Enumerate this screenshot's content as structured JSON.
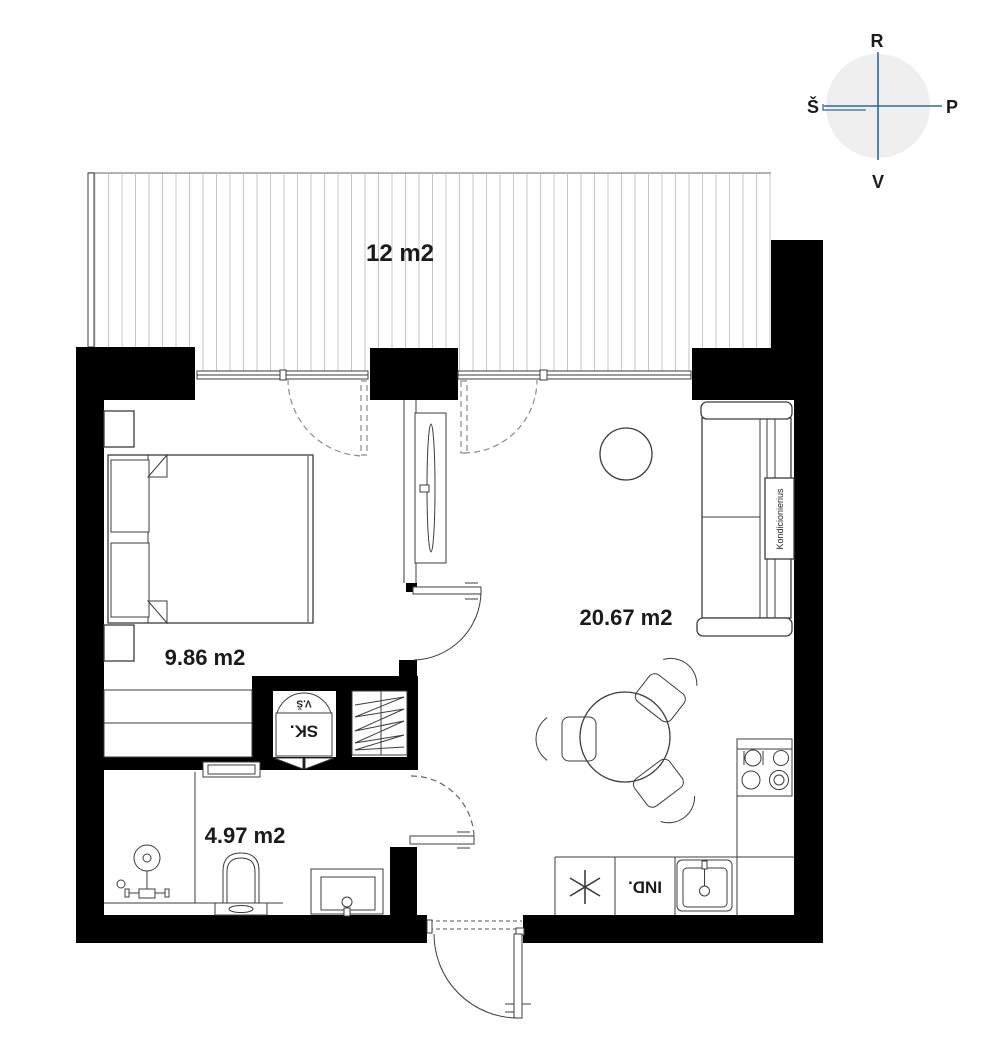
{
  "compass": {
    "top": "R",
    "right": "P",
    "bottom": "V",
    "left": "Š"
  },
  "rooms": {
    "terrace": {
      "area": "12 m2"
    },
    "bedroom": {
      "area": "9.86 m2"
    },
    "living_room": {
      "area": "20.67 m2"
    },
    "bathroom": {
      "area": "4.97 m2"
    }
  },
  "fixtures": {
    "shaft": "SK.",
    "vent": "V.Š",
    "dishwasher": "IND.",
    "air_conditioner": "Kondicionierius"
  },
  "colors": {
    "wall": "#000000",
    "line": "#3c3c3c",
    "deck_line": "#c6c6c6",
    "compass_line": "#2a6a9b",
    "compass_fill": "#efefef",
    "text": "#1b1b1b"
  }
}
